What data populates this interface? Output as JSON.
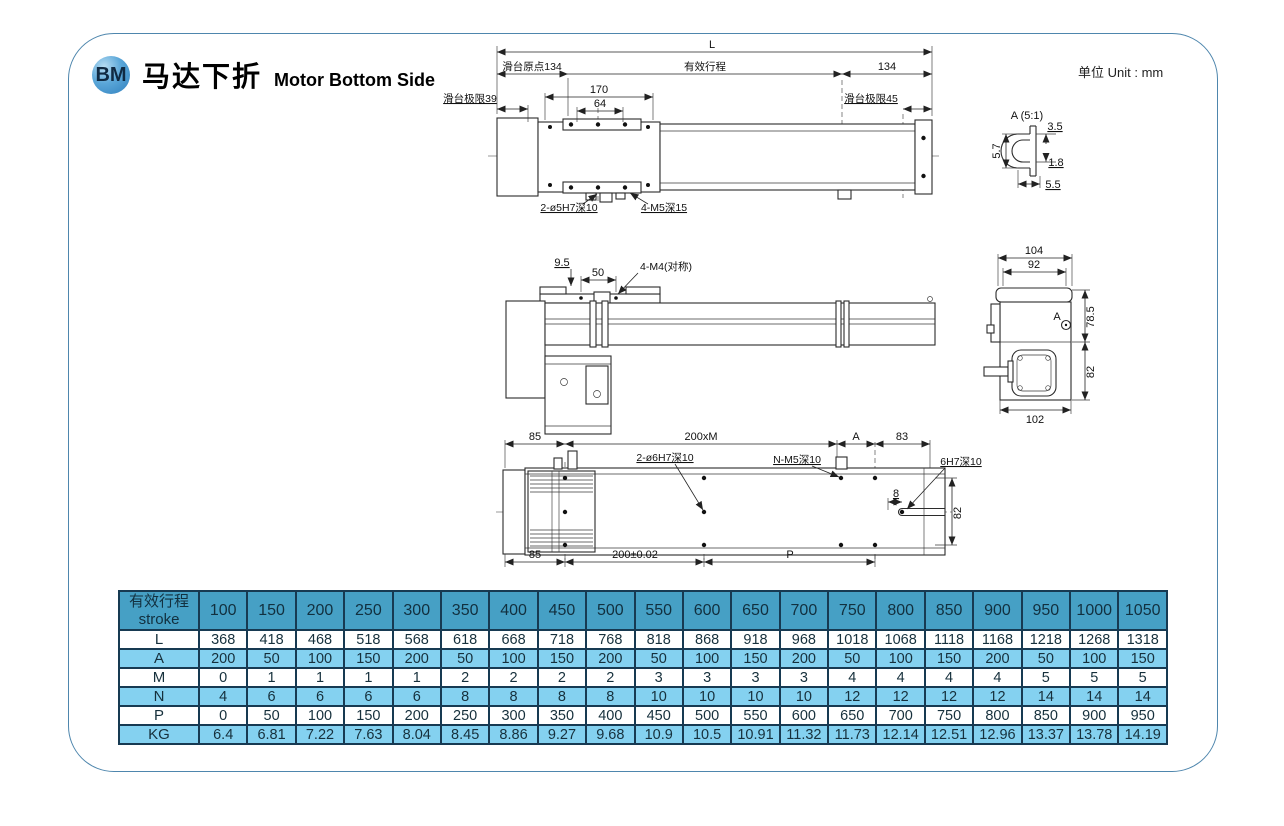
{
  "header": {
    "badge": "BM",
    "title_zh": "马达下折",
    "title_en": "Motor Bottom Side"
  },
  "colors": {
    "card_border": "#4e86ad",
    "table_border": "#173a52",
    "table_header_bg": "#46a0c5",
    "table_light_bg": "#84d1f0"
  },
  "drawings": {
    "unit_label": "单位 Unit : mm",
    "top_view": {
      "dim_L": "L",
      "dim_origin": "滑台原点134",
      "dim_stroke": "有效行程",
      "dim_134": "134",
      "dim_170": "170",
      "dim_64": "64",
      "dim_limit_left": "滑台极限39",
      "dim_limit_right": "滑台极限45",
      "label_holes_a": "2-ø5H7深10",
      "label_holes_b": "4-M5深15"
    },
    "detail_a": {
      "title": "A (5:1)",
      "dim_35": "3.5",
      "dim_57": "5.7",
      "dim_18": "1.8",
      "dim_55": "5.5"
    },
    "side_view": {
      "dim_95": "9.5",
      "dim_50": "50",
      "label_m4": "4-M4(对称)"
    },
    "end_view": {
      "dim_104": "104",
      "dim_92": "92",
      "dim_785": "78.5",
      "dim_82": "82",
      "dim_102": "102",
      "label_a": "A"
    },
    "bottom_view": {
      "dim_85_top": "85",
      "dim_200xm": "200xM",
      "dim_a": "A",
      "dim_83": "83",
      "label_holes": "2-ø6H7深10",
      "label_nm5": "N-M5深10",
      "label_6h7": "6H7深10",
      "dim_8": "8",
      "dim_82": "82",
      "dim_85_bottom": "85",
      "dim_200": "200±0.02",
      "dim_p": "P"
    }
  },
  "table": {
    "row_header_line1": "有效行程",
    "row_header_line2": "stroke",
    "strokes": [
      100,
      150,
      200,
      250,
      300,
      350,
      400,
      450,
      500,
      550,
      600,
      650,
      700,
      750,
      800,
      850,
      900,
      950,
      1000,
      1050
    ],
    "rows": [
      {
        "label": "L",
        "values": [
          368,
          418,
          468,
          518,
          568,
          618,
          668,
          718,
          768,
          818,
          868,
          918,
          968,
          1018,
          1068,
          1118,
          1168,
          1218,
          1268,
          1318
        ]
      },
      {
        "label": "A",
        "values": [
          200,
          50,
          100,
          150,
          200,
          50,
          100,
          150,
          200,
          50,
          100,
          150,
          200,
          50,
          100,
          150,
          200,
          50,
          100,
          150
        ]
      },
      {
        "label": "M",
        "values": [
          0,
          1,
          1,
          1,
          1,
          2,
          2,
          2,
          2,
          3,
          3,
          3,
          3,
          4,
          4,
          4,
          4,
          5,
          5,
          5
        ]
      },
      {
        "label": "N",
        "values": [
          4,
          6,
          6,
          6,
          6,
          8,
          8,
          8,
          8,
          10,
          10,
          10,
          10,
          12,
          12,
          12,
          12,
          14,
          14,
          14
        ]
      },
      {
        "label": "P",
        "values": [
          0,
          50,
          100,
          150,
          200,
          250,
          300,
          350,
          400,
          450,
          500,
          550,
          600,
          650,
          700,
          750,
          800,
          850,
          900,
          950
        ]
      },
      {
        "label": "KG",
        "values": [
          6.4,
          6.81,
          7.22,
          7.63,
          8.04,
          8.45,
          8.86,
          9.27,
          9.68,
          10.9,
          10.5,
          10.91,
          11.32,
          11.73,
          12.14,
          12.51,
          12.96,
          13.37,
          13.78,
          14.19
        ]
      }
    ]
  }
}
